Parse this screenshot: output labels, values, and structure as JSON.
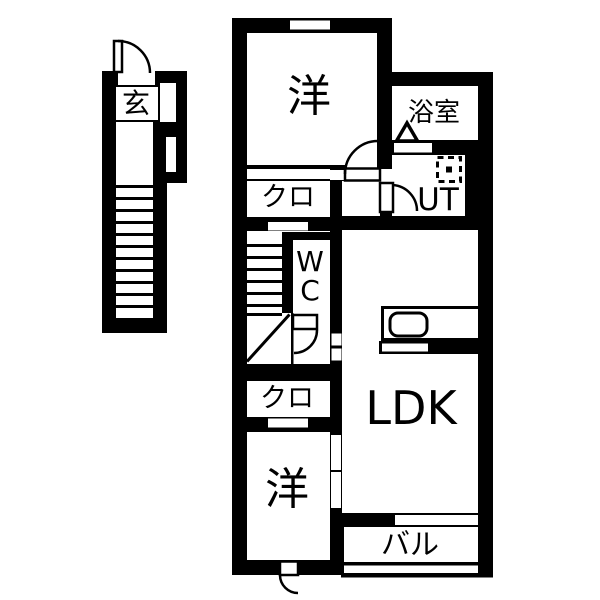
{
  "floorplan": {
    "type": "japanese-apartment-floorplan",
    "labels": {
      "genkan": "玄",
      "bedroom_top": "洋",
      "closet_top": "クロ",
      "wc_line1": "W",
      "wc_line2": "C",
      "bathroom": "浴室",
      "utility": "UT",
      "ldk": "LDK",
      "closet_bottom": "クロ",
      "bedroom_bottom": "洋",
      "balcony": "バル"
    },
    "colors": {
      "wall": "#000000",
      "floor": "#ffffff"
    }
  }
}
